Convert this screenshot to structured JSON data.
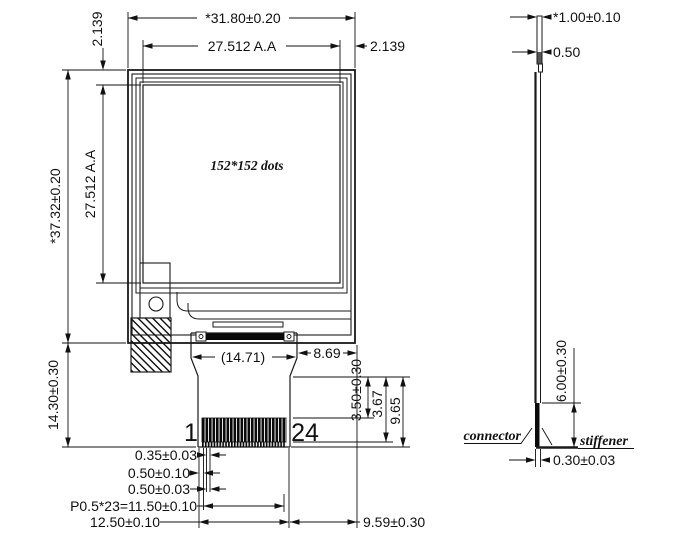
{
  "drawing": {
    "front_view": {
      "overall_width": "*31.80±0.20",
      "active_area_width": "27.512 A.A",
      "border_right": "2.139",
      "border_top": "2.139",
      "overall_height": "*37.32±0.20",
      "active_area_height": "27.512 A.A",
      "resolution": "152*152 dots",
      "fpc_bottom_length": "14.30±0.30",
      "fpc_width_ref": "(14.71)",
      "fpc_right_offset": "8.69",
      "contact_length": "3.50±0.30",
      "contact_length_tip": "3.67",
      "tail_length": "9.65",
      "pin_first": "1",
      "pin_last": "24",
      "pad_width": "0.35±0.03",
      "pad_edge_gap": "0.50±0.10",
      "pad_pitch": "0.50±0.03",
      "pitch_total": "P0.5*23=11.50±0.10",
      "contact_area_width": "12.50±0.10",
      "tail_right_offset": "9.59±0.30"
    },
    "side_view": {
      "total_thickness": "*1.00±0.10",
      "glass_thickness": "0.50",
      "connector_depth": "6.00±0.30",
      "connector_label": "connector",
      "stiffener_label": "stiffener",
      "fpc_thickness": "0.30±0.03"
    },
    "colors": {
      "line": "#1a1a1a",
      "background": "#ffffff"
    }
  }
}
